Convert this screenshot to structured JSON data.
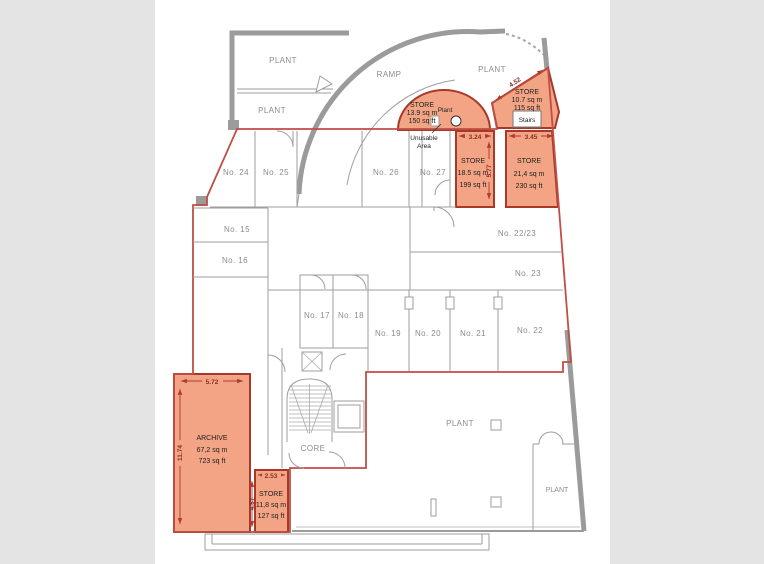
{
  "colors": {
    "background": "#e4e4e4",
    "canvas": "#ffffff",
    "wall_gray": "#9b9b9b",
    "boundary_red": "#bf4f45",
    "highlight_fill": "#f3a485",
    "highlight_border": "#a8392a",
    "room_label_gray": "#8c8c8c",
    "dimension_red": "#8b2f24"
  },
  "labels": {
    "plant_top_upper": "PLANT",
    "plant_top_lower": "PLANT",
    "plant_top_right": "PLANT",
    "plant_bottom": "PLANT",
    "plant_bottom_right": "PLANT",
    "ramp": "RAMP",
    "core": "CORE",
    "stairs": "Stairs",
    "plant_point": "Plant",
    "unusable_line1": "Unusable",
    "unusable_line2": "Area"
  },
  "rooms": {
    "no24": "No. 24",
    "no25": "No. 25",
    "no26": "No. 26",
    "no27": "No. 27",
    "no15": "No. 15",
    "no16": "No. 16",
    "no17": "No. 17",
    "no18": "No. 18",
    "no19": "No. 19",
    "no20": "No. 20",
    "no21": "No. 21",
    "no22": "No. 22",
    "no2223": "No. 22/23",
    "no23": "No. 23"
  },
  "highlighted_rooms": {
    "store_ramp": {
      "name": "STORE",
      "area_m": "13.9 sq m",
      "area_ft": "150 sq ft"
    },
    "store_ne": {
      "name": "STORE",
      "area_m": "10.7 sq m",
      "area_ft": "115 sq ft",
      "dim_top": "4.52"
    },
    "store_mid": {
      "name": "STORE",
      "area_m": "18.5 sq m",
      "area_ft": "199 sq ft",
      "dim_top": "3.24",
      "dim_side": "5.77"
    },
    "store_right": {
      "name": "STORE",
      "area_m": "21,4 sq m",
      "area_ft": "230 sq ft",
      "dim_top": "3.45"
    },
    "archive": {
      "name": "ARCHIVE",
      "area_m": "67,2 sq m",
      "area_ft": "723 sq ft",
      "dim_top": "5.72",
      "dim_side": "11.74"
    },
    "store_sw": {
      "name": "STORE",
      "area_m": "11,8 sq m",
      "area_ft": "127 sq ft",
      "dim_top": "2.53",
      "dim_side": "4.57"
    }
  }
}
